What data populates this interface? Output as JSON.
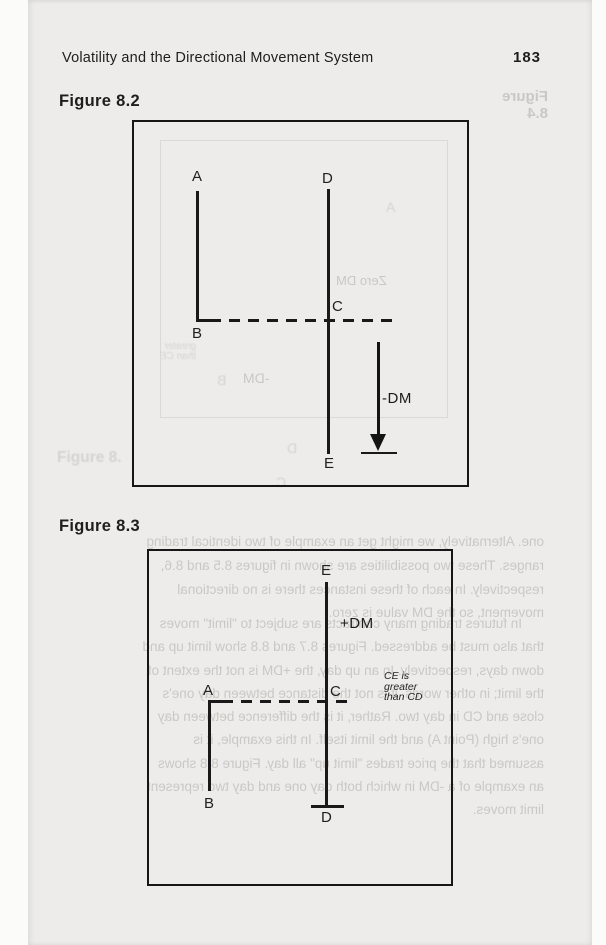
{
  "header": {
    "title": "Volatility and the Directional Movement System",
    "page_number": "183"
  },
  "figure_8_2": {
    "label": "Figure 8.2",
    "point_a": "A",
    "point_b": "B",
    "point_c": "C",
    "point_d": "D",
    "point_e": "E",
    "annotation": "-DM"
  },
  "figure_8_3": {
    "label": "Figure 8.3",
    "point_a": "A",
    "point_b": "B",
    "point_c": "C",
    "point_d": "D",
    "point_e": "E",
    "annotation": "+DM",
    "note_lines": [
      "CE is",
      "greater",
      "than CD"
    ]
  },
  "bleed_through": {
    "caption_top_right": "Figure 8.4",
    "caption_left": "Figure 8.",
    "fig2_zero_dm": "Zero DM",
    "fig2_neg_dm": "-DM",
    "fig2_point_a": "A",
    "fig2_point_b": "B",
    "fig2_point_c": "C",
    "fig2_point_d": "D",
    "fig2_note_lines": [
      "greater",
      "than CE"
    ],
    "paragraph1_lines": [
      "one. Alternatively, we might get an example of two identical trading",
      "ranges. These two possibilities are shown in figures 8.5 and 8.6,",
      "respectively. In each of these instances there is no directional",
      "movement, so the DM value is zero."
    ],
    "paragraph2_lines": [
      "In futures trading many contracts are subject to \"limit\" moves",
      "that also must be addressed. Figures 8.7 and 8.8 show limit up and",
      "down days, respectively. In an up day, the +DM is not the extent of",
      "the limit; in other words, it is not the distance between day one's",
      "close and CD in day two. Rather, it is the difference between day",
      "one's high (Point A) and the limit itself. In this example, it is",
      "assumed that the price trades \"limit up\" all day. Figure 8.8 shows",
      "an example of a -DM in which both day one and day two represent",
      "limit moves."
    ]
  }
}
